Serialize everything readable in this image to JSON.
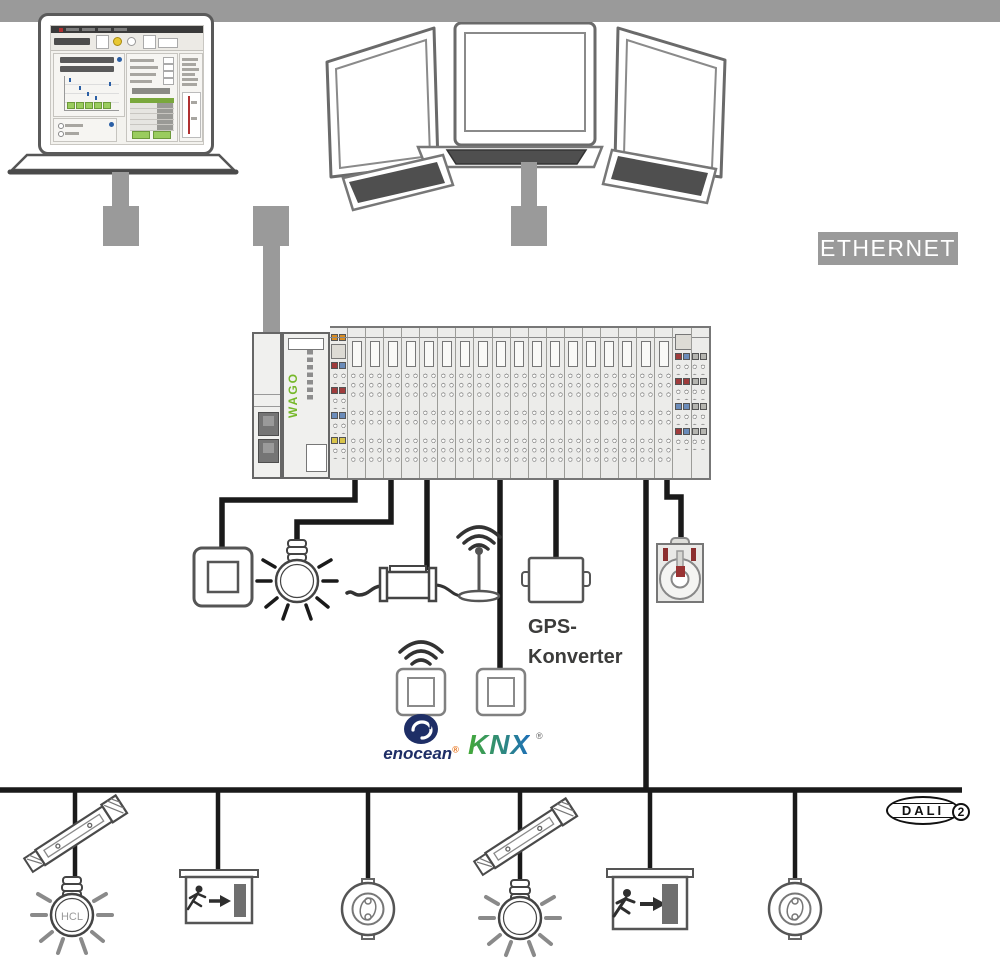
{
  "labels": {
    "ethernet": "ETHERNET",
    "gps_line1": "GPS-",
    "gps_line2": "Konverter",
    "hcl": "HCL",
    "wago": "WAGO"
  },
  "logos": {
    "enocean": {
      "text": "enocean",
      "registered": "®"
    },
    "knx": {
      "text": "KNX",
      "registered": "®"
    },
    "dali": {
      "text": "DALI",
      "version": "2"
    }
  },
  "controller": {
    "brand": "WAGO",
    "io_module_count": 21
  },
  "palette": {
    "bus_gray": "#9a9a9a",
    "wire_black": "#1a1a1a",
    "wago_green": "#76b82a",
    "enocean_navy": "#1e2e66",
    "enocean_orange": "#e87722",
    "knx_green": "#44a938",
    "knx_blue": "#1d6fb7",
    "chip_orange": "#d98c21",
    "chip_red": "#a03c3c",
    "chip_blue": "#6b8cba",
    "chip_yellow": "#d9c44a",
    "sensor_mark_red": "#8c2f2f"
  }
}
